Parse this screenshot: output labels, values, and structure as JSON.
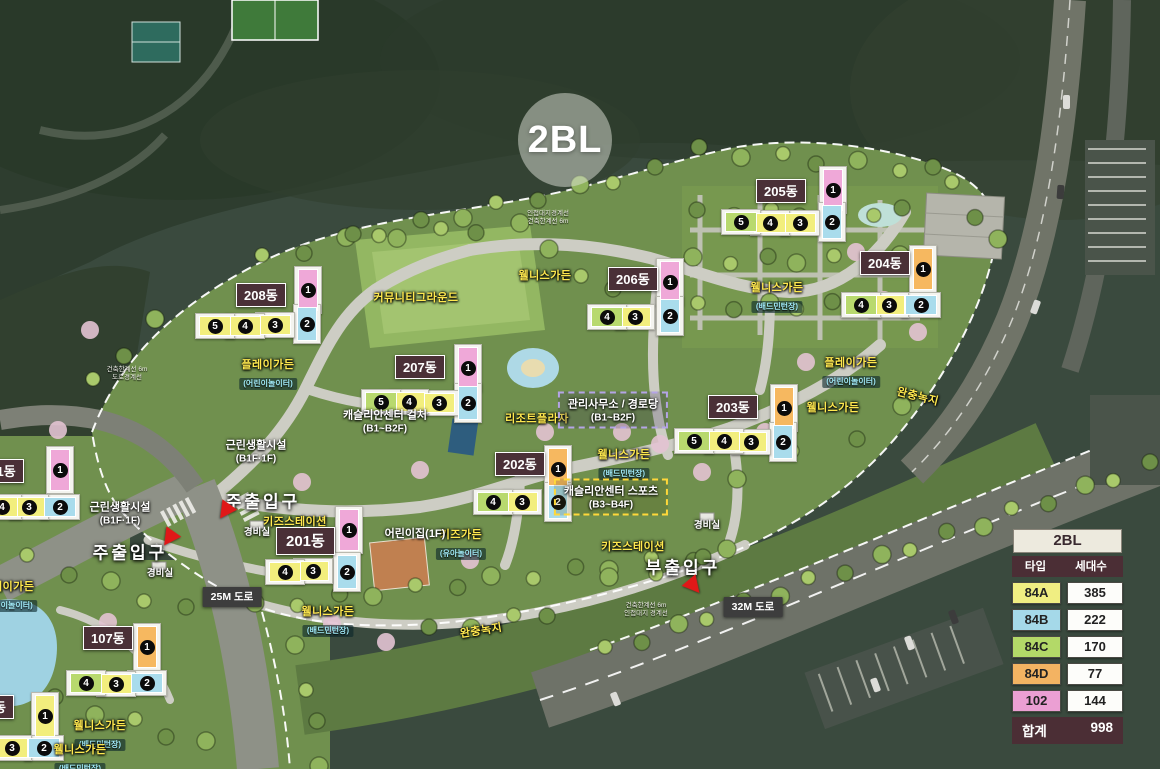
{
  "map": {
    "block_label": "2BL",
    "unit_types": {
      "84A": "#f2ee7d",
      "84B": "#a9dcec",
      "84C": "#b8d96e",
      "84D": "#f6b860",
      "102": "#efa8d8"
    },
    "buildings": [
      {
        "label": "205동",
        "lx": 756,
        "ly": 179,
        "units": [
          [
            "1",
            "102",
            833,
            190,
            "v"
          ],
          [
            "2",
            "84B",
            832,
            222,
            "v"
          ],
          [
            "3",
            "84A",
            800,
            223,
            "h"
          ],
          [
            "4",
            "84A",
            770,
            223,
            "h"
          ],
          [
            "5",
            "84C",
            741,
            222,
            "h"
          ]
        ]
      },
      {
        "label": "206동",
        "lx": 608,
        "ly": 267,
        "units": [
          [
            "1",
            "102",
            670,
            282,
            "v"
          ],
          [
            "2",
            "84B",
            670,
            316,
            "v"
          ],
          [
            "3",
            "84A",
            635,
            317,
            "h"
          ],
          [
            "4",
            "84C",
            607,
            317,
            "h"
          ]
        ]
      },
      {
        "label": "204동",
        "lx": 860,
        "ly": 251,
        "units": [
          [
            "1",
            "84D",
            923,
            269,
            "v"
          ],
          [
            "2",
            "84B",
            921,
            305,
            "h"
          ],
          [
            "3",
            "84A",
            889,
            305,
            "h"
          ],
          [
            "4",
            "84C",
            861,
            305,
            "h"
          ]
        ]
      },
      {
        "label": "208동",
        "lx": 236,
        "ly": 283,
        "units": [
          [
            "1",
            "102",
            308,
            290,
            "v"
          ],
          [
            "2",
            "84B",
            307,
            324,
            "v"
          ],
          [
            "3",
            "84A",
            275,
            325,
            "h"
          ],
          [
            "4",
            "84A",
            245,
            326,
            "h"
          ],
          [
            "5",
            "84A",
            215,
            326,
            "h"
          ]
        ]
      },
      {
        "label": "207동",
        "lx": 395,
        "ly": 355,
        "units": [
          [
            "1",
            "102",
            468,
            368,
            "v"
          ],
          [
            "2",
            "84B",
            468,
            403,
            "v"
          ],
          [
            "3",
            "84A",
            439,
            403,
            "h"
          ],
          [
            "4",
            "84A",
            409,
            402,
            "h"
          ],
          [
            "5",
            "84C",
            381,
            402,
            "h"
          ]
        ]
      },
      {
        "label": "203동",
        "lx": 708,
        "ly": 395,
        "units": [
          [
            "1",
            "84D",
            784,
            408,
            "v"
          ],
          [
            "2",
            "84B",
            783,
            442,
            "v"
          ],
          [
            "3",
            "84A",
            751,
            442,
            "h"
          ],
          [
            "4",
            "84A",
            724,
            441,
            "h"
          ],
          [
            "5",
            "84C",
            694,
            441,
            "h"
          ]
        ]
      },
      {
        "label": "202동",
        "lx": 495,
        "ly": 452,
        "units": [
          [
            "1",
            "84D",
            558,
            469,
            "v"
          ],
          [
            "2",
            "84B",
            558,
            502,
            "v"
          ],
          [
            "3",
            "84A",
            522,
            502,
            "h"
          ],
          [
            "4",
            "84C",
            493,
            502,
            "h"
          ]
        ]
      },
      {
        "label": "201동",
        "lx": 276,
        "ly": 527,
        "big": true,
        "units": [
          [
            "1",
            "102",
            349,
            530,
            "v"
          ],
          [
            "2",
            "84B",
            347,
            572,
            "v"
          ],
          [
            "3",
            "84A",
            313,
            571,
            "h"
          ],
          [
            "4",
            "84A",
            285,
            572,
            "h"
          ]
        ]
      },
      {
        "label": "107동",
        "lx": 83,
        "ly": 626,
        "units": [
          [
            "1",
            "84D",
            147,
            647,
            "v"
          ],
          [
            "2",
            "84B",
            147,
            683,
            "h"
          ],
          [
            "3",
            "84A",
            116,
            684,
            "h"
          ],
          [
            "4",
            "84C",
            86,
            683,
            "h"
          ]
        ]
      },
      {
        "label": "101동",
        "lx": -26,
        "ly": 459,
        "units": [
          [
            "1",
            "102",
            60,
            470,
            "v"
          ],
          [
            "2",
            "84B",
            60,
            507,
            "h"
          ],
          [
            "3",
            "84A",
            29,
            507,
            "h"
          ],
          [
            "4",
            "84A",
            2,
            507,
            "h"
          ]
        ]
      },
      {
        "label": "동",
        "lx": -14,
        "ly": 695,
        "units": [
          [
            "1",
            "84A",
            45,
            716,
            "v"
          ],
          [
            "2",
            "84B",
            44,
            748,
            "h"
          ],
          [
            "3",
            "84A",
            12,
            748,
            "h"
          ]
        ]
      }
    ],
    "labels": [
      {
        "t": "커뮤니티그라운드",
        "s": "y",
        "x": 416,
        "y": 297
      },
      {
        "t": "웰니스가든",
        "s": "y",
        "x": 545,
        "y": 275
      },
      {
        "t": "웰니스가든",
        "s": "y",
        "x": 777,
        "y": 296,
        "sub": "(배드민턴장)"
      },
      {
        "t": "플레이가든",
        "s": "y",
        "x": 851,
        "y": 371,
        "sub": "(어린이놀이터)"
      },
      {
        "t": "플레이가든",
        "s": "y",
        "x": 268,
        "y": 373,
        "sub": "(어린이놀이터)"
      },
      {
        "t": "웰니스가든",
        "s": "y",
        "x": 833,
        "y": 407
      },
      {
        "t": "리조트플라자",
        "s": "y",
        "x": 537,
        "y": 418
      },
      {
        "t": "웰니스가든",
        "s": "y",
        "x": 624,
        "y": 463,
        "sub": "(배드민턴장)"
      },
      {
        "t": "키즈스테이션",
        "s": "y",
        "x": 295,
        "y": 521
      },
      {
        "t": "키즈가든",
        "s": "y",
        "x": 461,
        "y": 543,
        "sub": "(유아놀이터)"
      },
      {
        "t": "키즈스테이션",
        "s": "y",
        "x": 633,
        "y": 546
      },
      {
        "t": "웰니스가든",
        "s": "y",
        "x": 328,
        "y": 620,
        "sub": "(배드민턴장)"
      },
      {
        "t": "웰니스가든",
        "s": "y",
        "x": 100,
        "y": 734,
        "sub": "(배드민턴장)"
      },
      {
        "t": "웰니스가든",
        "s": "y",
        "x": 80,
        "y": 758,
        "sub": "(배드민턴장)"
      },
      {
        "t": "플레이가든",
        "s": "y",
        "x": 8,
        "y": 595,
        "sub": "(어린이놀이터)"
      },
      {
        "t": "완충녹지",
        "s": "y",
        "x": 918,
        "y": 396,
        "rot": 14
      },
      {
        "t": "완충녹지",
        "s": "y",
        "x": 481,
        "y": 630,
        "rot": -9
      },
      {
        "t": "캐슬리안센터  컬처",
        "s": "w",
        "x": 385,
        "y": 420,
        "sub2": "(B1~B2F)"
      },
      {
        "t": "캐슬리안센터  스포츠",
        "s": "boxy",
        "x": 611,
        "y": 497,
        "sub2": "(B3~B4F)"
      },
      {
        "t": "관리사무소 / 경로당",
        "s": "boxp",
        "x": 613,
        "y": 410,
        "sub2": "(B1~B2F)"
      },
      {
        "t": "근린생활시설",
        "s": "w",
        "x": 256,
        "y": 450,
        "sub2": "(B1F·1F)"
      },
      {
        "t": "근린생활시설",
        "s": "w",
        "x": 120,
        "y": 512,
        "sub2": "(B1F·1F)"
      },
      {
        "t": "어린이집(1F)",
        "s": "w",
        "x": 415,
        "y": 533
      },
      {
        "t": "주출입구",
        "s": "big",
        "x": 263,
        "y": 500
      },
      {
        "t": "주출입구",
        "s": "big",
        "x": 130,
        "y": 551
      },
      {
        "t": "부출입구",
        "s": "big",
        "x": 683,
        "y": 566
      },
      {
        "t": "경비실",
        "s": "w2",
        "x": 257,
        "y": 531
      },
      {
        "t": "경비실",
        "s": "w2",
        "x": 160,
        "y": 572
      },
      {
        "t": "경비실",
        "s": "w2",
        "x": 707,
        "y": 524
      },
      {
        "t": "25M 도로",
        "s": "road",
        "x": 232,
        "y": 597
      },
      {
        "t": "32M 도로",
        "s": "road",
        "x": 753,
        "y": 607
      },
      {
        "t": "인접대지경계선",
        "s": "tiny",
        "x": 548,
        "y": 218,
        "sub2": "건축한계선 6m"
      },
      {
        "t": "건축한계선 6m",
        "s": "tiny",
        "x": 127,
        "y": 374,
        "sub2": "도로경계선"
      },
      {
        "t": "건축한계선 6m",
        "s": "tiny",
        "x": 646,
        "y": 610,
        "sub2": "인접대지 경계선"
      }
    ],
    "arrows": [
      {
        "x": 225,
        "y": 512,
        "rot": 35
      },
      {
        "x": 169,
        "y": 539,
        "rot": 35
      },
      {
        "x": 694,
        "y": 587,
        "rot": -40
      }
    ]
  },
  "legend": {
    "title": "2BL",
    "columns": [
      "타입",
      "세대수"
    ],
    "rows": [
      {
        "type": "84A",
        "count": "385",
        "color": "#f0ee82"
      },
      {
        "type": "84B",
        "count": "222",
        "color": "#a5d9e9"
      },
      {
        "type": "84C",
        "count": "170",
        "color": "#b3d968"
      },
      {
        "type": "84D",
        "count": "77",
        "color": "#f3b362"
      },
      {
        "type": "102",
        "count": "144",
        "color": "#eb9fd3"
      }
    ],
    "total_label": "합계",
    "total": "998"
  }
}
